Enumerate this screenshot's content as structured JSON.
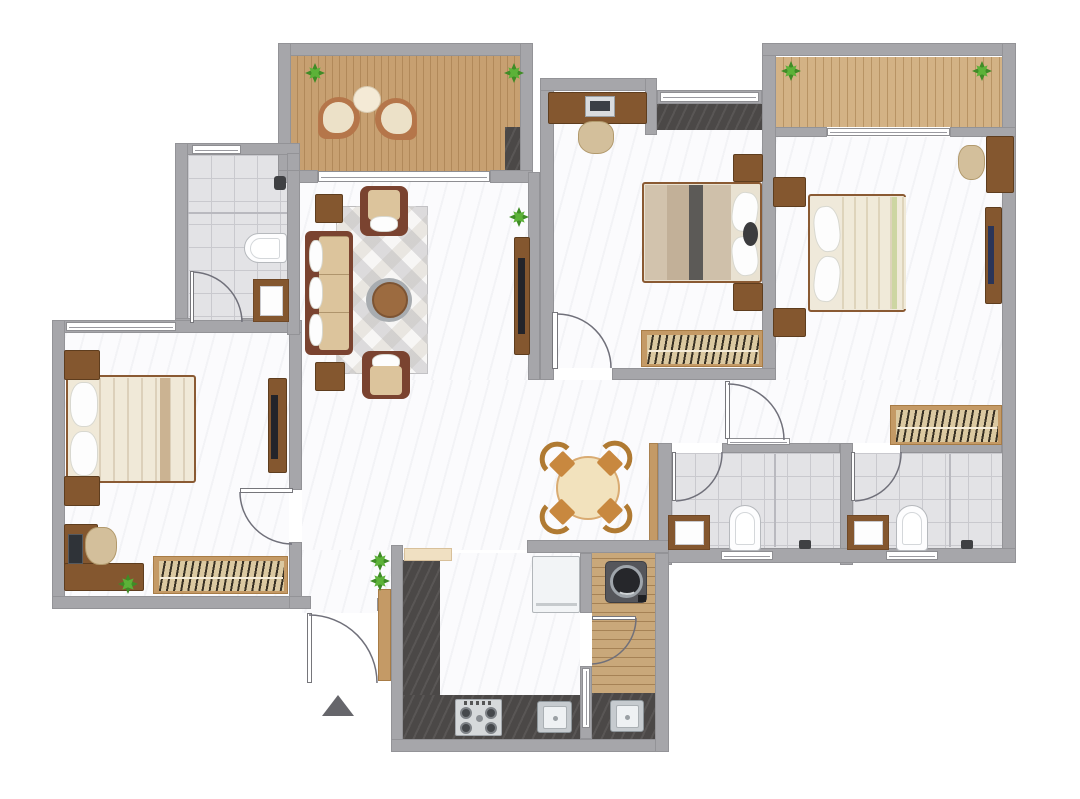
{
  "document_type": "apartment-floor-plan-3bhk",
  "visible_text": [],
  "colors": {
    "exterior": "#ffffff",
    "floor": "#fbfbfd",
    "wall": "#a6a6aa",
    "tile": "#e3e3e6",
    "tileLine": "#c9c9ce",
    "deck": "#c7a071",
    "deckLine": "#b1895a",
    "deck2": "#d3b285",
    "utilityWood": "#c9a87a",
    "darkMarble": "#4b4847",
    "woodFurniture": "#84572f",
    "woodLight": "#c49a66",
    "wardrobeInner": "#dbc9a1",
    "cream": "#f0e9d8",
    "sofaFrame": "#7a4330",
    "cushion": "#dcc49c",
    "cushionLight": "#e9d8b4",
    "rust": "#b5764a",
    "chairTan": "#c8883f",
    "chairBack": "#b07a32",
    "tableCream": "#f2e2bd",
    "plantGreen": "#3f8c26",
    "plantLight": "#5cb238",
    "rug": "#e9e6e1",
    "tv": "#23242a",
    "arcStroke": "#70707a",
    "marker": "#66666b",
    "blanketDark": "#5c5a57",
    "blanketBeige": "#cbb89e"
  },
  "rooms": [
    {
      "id": "balcony-1",
      "furniture": [
        "lounge-chair",
        "lounge-chair",
        "round-side-table",
        "plant",
        "plant",
        "door-mat"
      ]
    },
    {
      "id": "living-room",
      "furniture": [
        "three-seat-sofa",
        "armchair",
        "armchair",
        "side-table",
        "side-table",
        "coffee-table",
        "area-rug",
        "tv-unit",
        "plant"
      ]
    },
    {
      "id": "bathroom-1",
      "furniture": [
        "toilet",
        "washbasin",
        "shower-head",
        "window",
        "door"
      ]
    },
    {
      "id": "bedroom-1",
      "furniture": [
        "double-bed",
        "nightstand",
        "nightstand",
        "tv-unit",
        "study-desk",
        "desk-chair",
        "computer",
        "wardrobe",
        "plant",
        "window",
        "door"
      ]
    },
    {
      "id": "bedroom-2",
      "furniture": [
        "study-desk",
        "computer",
        "desk-chair",
        "double-bed",
        "nightstand",
        "nightstand",
        "wardrobe",
        "window",
        "window-mat",
        "door"
      ]
    },
    {
      "id": "balcony-2",
      "furniture": [
        "plant",
        "plant"
      ]
    },
    {
      "id": "bedroom-3",
      "furniture": [
        "double-bed",
        "nightstand",
        "nightstand",
        "desk",
        "desk-chair",
        "tv-unit",
        "wardrobe",
        "door"
      ]
    },
    {
      "id": "dining-area",
      "furniture": [
        "round-dining-table",
        "dining-chair",
        "dining-chair",
        "dining-chair",
        "dining-chair"
      ]
    },
    {
      "id": "bathroom-2",
      "furniture": [
        "washbasin",
        "toilet",
        "shower-tap",
        "shower-screen",
        "window",
        "door"
      ]
    },
    {
      "id": "bathroom-3",
      "furniture": [
        "washbasin",
        "toilet",
        "shower-tap",
        "shower-screen",
        "window",
        "door"
      ]
    },
    {
      "id": "kitchen",
      "furniture": [
        "l-shaped-counter",
        "gas-stove",
        "sink",
        "refrigerator",
        "breakfast-shelf"
      ]
    },
    {
      "id": "utility-balcony",
      "furniture": [
        "washing-machine",
        "counter",
        "sink",
        "window",
        "door"
      ]
    },
    {
      "id": "entrance",
      "furniture": [
        "entry-door",
        "shoe-cabinet",
        "plant",
        "plant",
        "entry-direction-marker"
      ]
    }
  ]
}
